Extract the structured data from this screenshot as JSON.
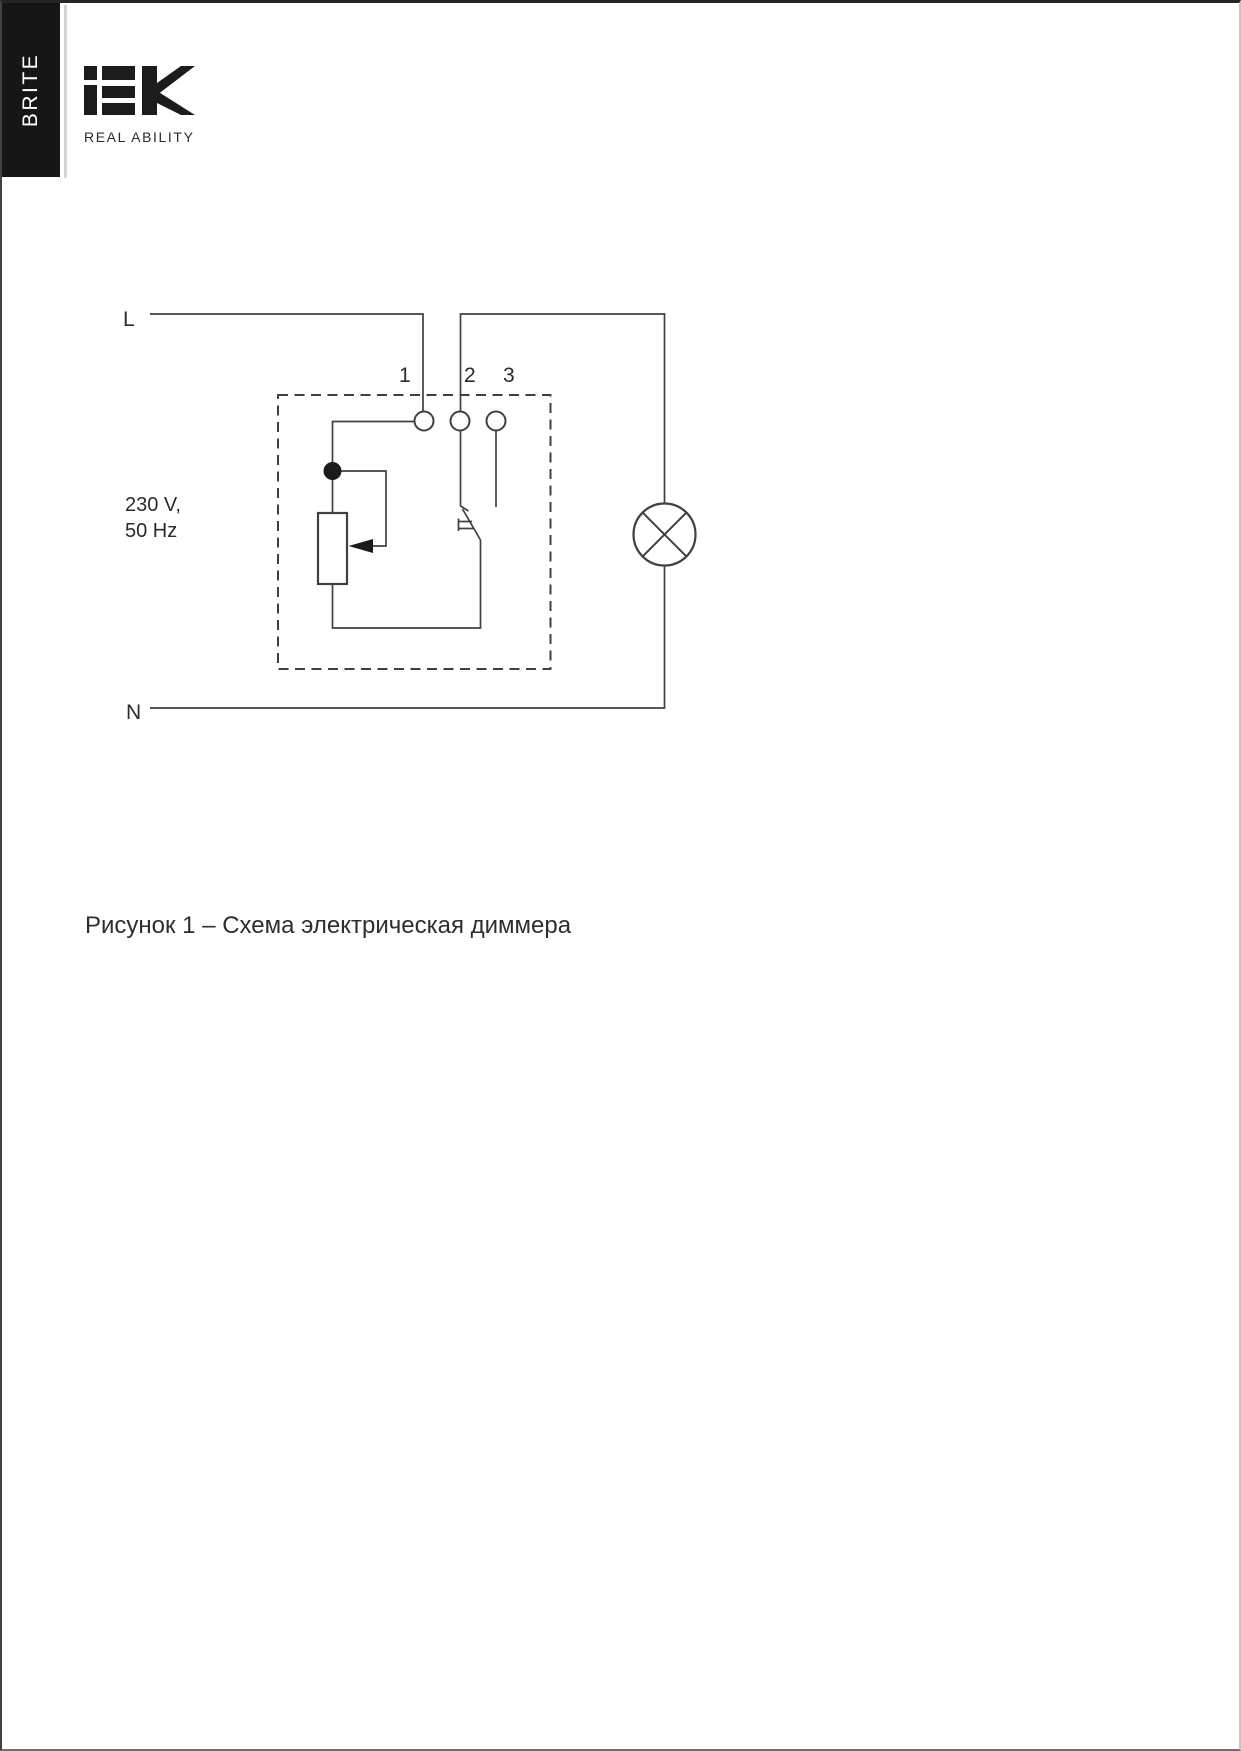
{
  "brand": {
    "bar_label": "BRITE",
    "logo_text": "IEK",
    "tagline": "REAL ABILITY"
  },
  "diagram": {
    "source_label": "L",
    "neutral_label": "N",
    "voltage_line1": "230 V,",
    "voltage_line2": "50 Hz",
    "terminals": [
      "1",
      "2",
      "3"
    ],
    "components": {
      "enclosure": "dimmer-dashed-box",
      "potentiometer": "resistor-with-wiper-arrow",
      "switch": "push-button-switch",
      "load": "lamp-crossed-circle"
    }
  },
  "caption": "Рисунок 1 – Схема электрическая диммера",
  "colors": {
    "wire": "#404040",
    "text": "#2b2b2b",
    "bar_background": "#161616",
    "bar_text": "#ffffff",
    "logo": "#1c1c1c",
    "junction_dot": "#1a1a1a"
  }
}
